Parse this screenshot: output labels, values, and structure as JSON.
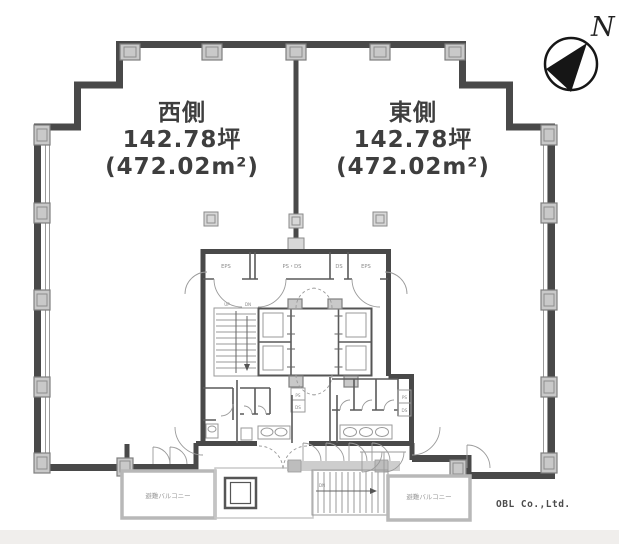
{
  "units": {
    "west": {
      "name": "西側",
      "area_tsubo": "142.78坪",
      "area_sqm": "(472.02m²)"
    },
    "east": {
      "name": "東側",
      "area_tsubo": "142.78坪",
      "area_sqm": "(472.02m²)"
    }
  },
  "compass": {
    "north_label": "N"
  },
  "credit": {
    "company": "OBL Co.,Ltd."
  },
  "core": {
    "shaft_rooms": {
      "eps_left": "EPS",
      "ps_ds": "PS・DS",
      "ds": "DS",
      "eps_right": "EPS"
    },
    "pipe_shafts": {
      "ps": "PS",
      "ds": "DS"
    },
    "stair": {
      "up": "UP",
      "down": "DN"
    }
  },
  "balconies": {
    "left_label": "避難バルコニー",
    "right_label": "避難バルコニー"
  },
  "colors": {
    "wall": "#494949",
    "column_fill": "#c9c9c9",
    "light_wall": "#b8b8b8",
    "thin_line": "#9a9a9a",
    "label_text": "#3e3e3e",
    "footer_band": "#f0eeec",
    "compass_ink": "#161616"
  }
}
